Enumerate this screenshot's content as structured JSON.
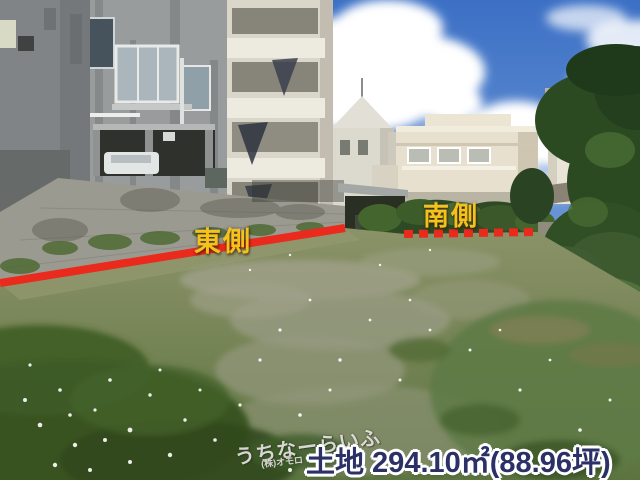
{
  "annotations": {
    "east": {
      "label": "東側",
      "line_style": "solid"
    },
    "south": {
      "label": "南側",
      "line_style": "dashed"
    },
    "line_color": "#ea2a1d",
    "label_color": "#f4c21a"
  },
  "caption": {
    "text": "土地 294.10㎡(88.96坪)",
    "color": "#2b3166"
  },
  "watermark": {
    "logo": "うちなーらいふ",
    "company": "(株)オモロ"
  },
  "scene_colors": {
    "sky": "#3c70c5",
    "cloud": "#ffffff",
    "concrete_building": "#999c9c",
    "cream_house": "#e7e0cf",
    "block_wall": "#9b9a90",
    "foliage_dark": "#2c4a22",
    "grass_light": "#879064",
    "grass_dark": "#36511f",
    "gravel": "#a2a28c"
  }
}
